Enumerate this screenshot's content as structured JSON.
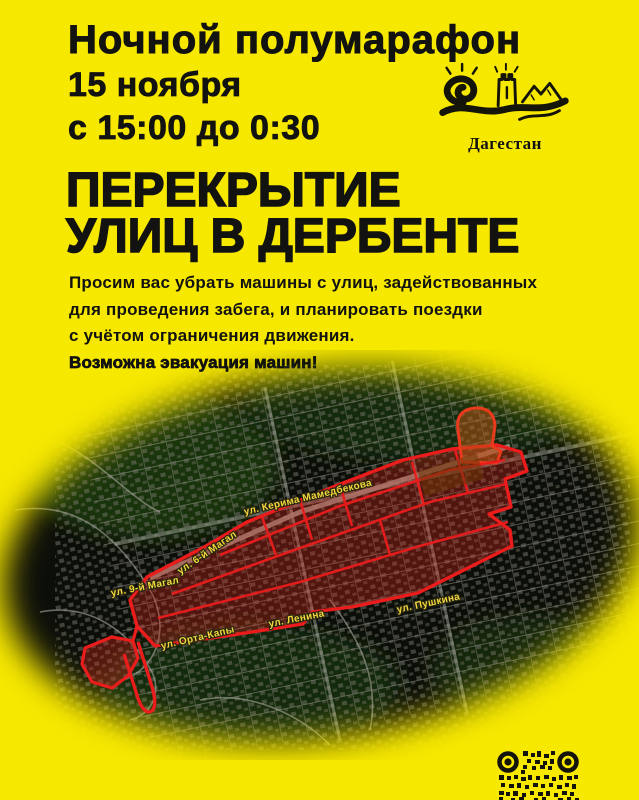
{
  "poster": {
    "title": "Ночной полумарафон",
    "date": {
      "line1": "15 ноября",
      "line2": "с 15:00 до 0:30"
    },
    "headline": {
      "line1": "ПЕРЕКРЫТИЕ",
      "line2": "УЛИЦ В ДЕРБЕНТЕ"
    },
    "body": {
      "line1": "Просим вас убрать машины с улиц, задействованных",
      "line2": "для проведения забега, и планировать поездки",
      "line3": "с учётом ограничения движения.",
      "warning": "Возможна эвакуация машин!"
    }
  },
  "logo": {
    "caption": "Дагестан"
  },
  "map": {
    "street_labels": [
      "ул. Керима Мамедбекова",
      "ул. 6-й Магал",
      "ул. 9-й Магал",
      "ул. Орта-Капы",
      "ул. Ленина",
      "ул. Пушкина"
    ]
  },
  "colors": {
    "background_yellow": "#F7E800",
    "text_black": "#121210",
    "closure_red": "#EA1C1C",
    "closure_fill": "rgba(220,40,28,0.33)",
    "street_label_yellow": "#F4D63E"
  }
}
